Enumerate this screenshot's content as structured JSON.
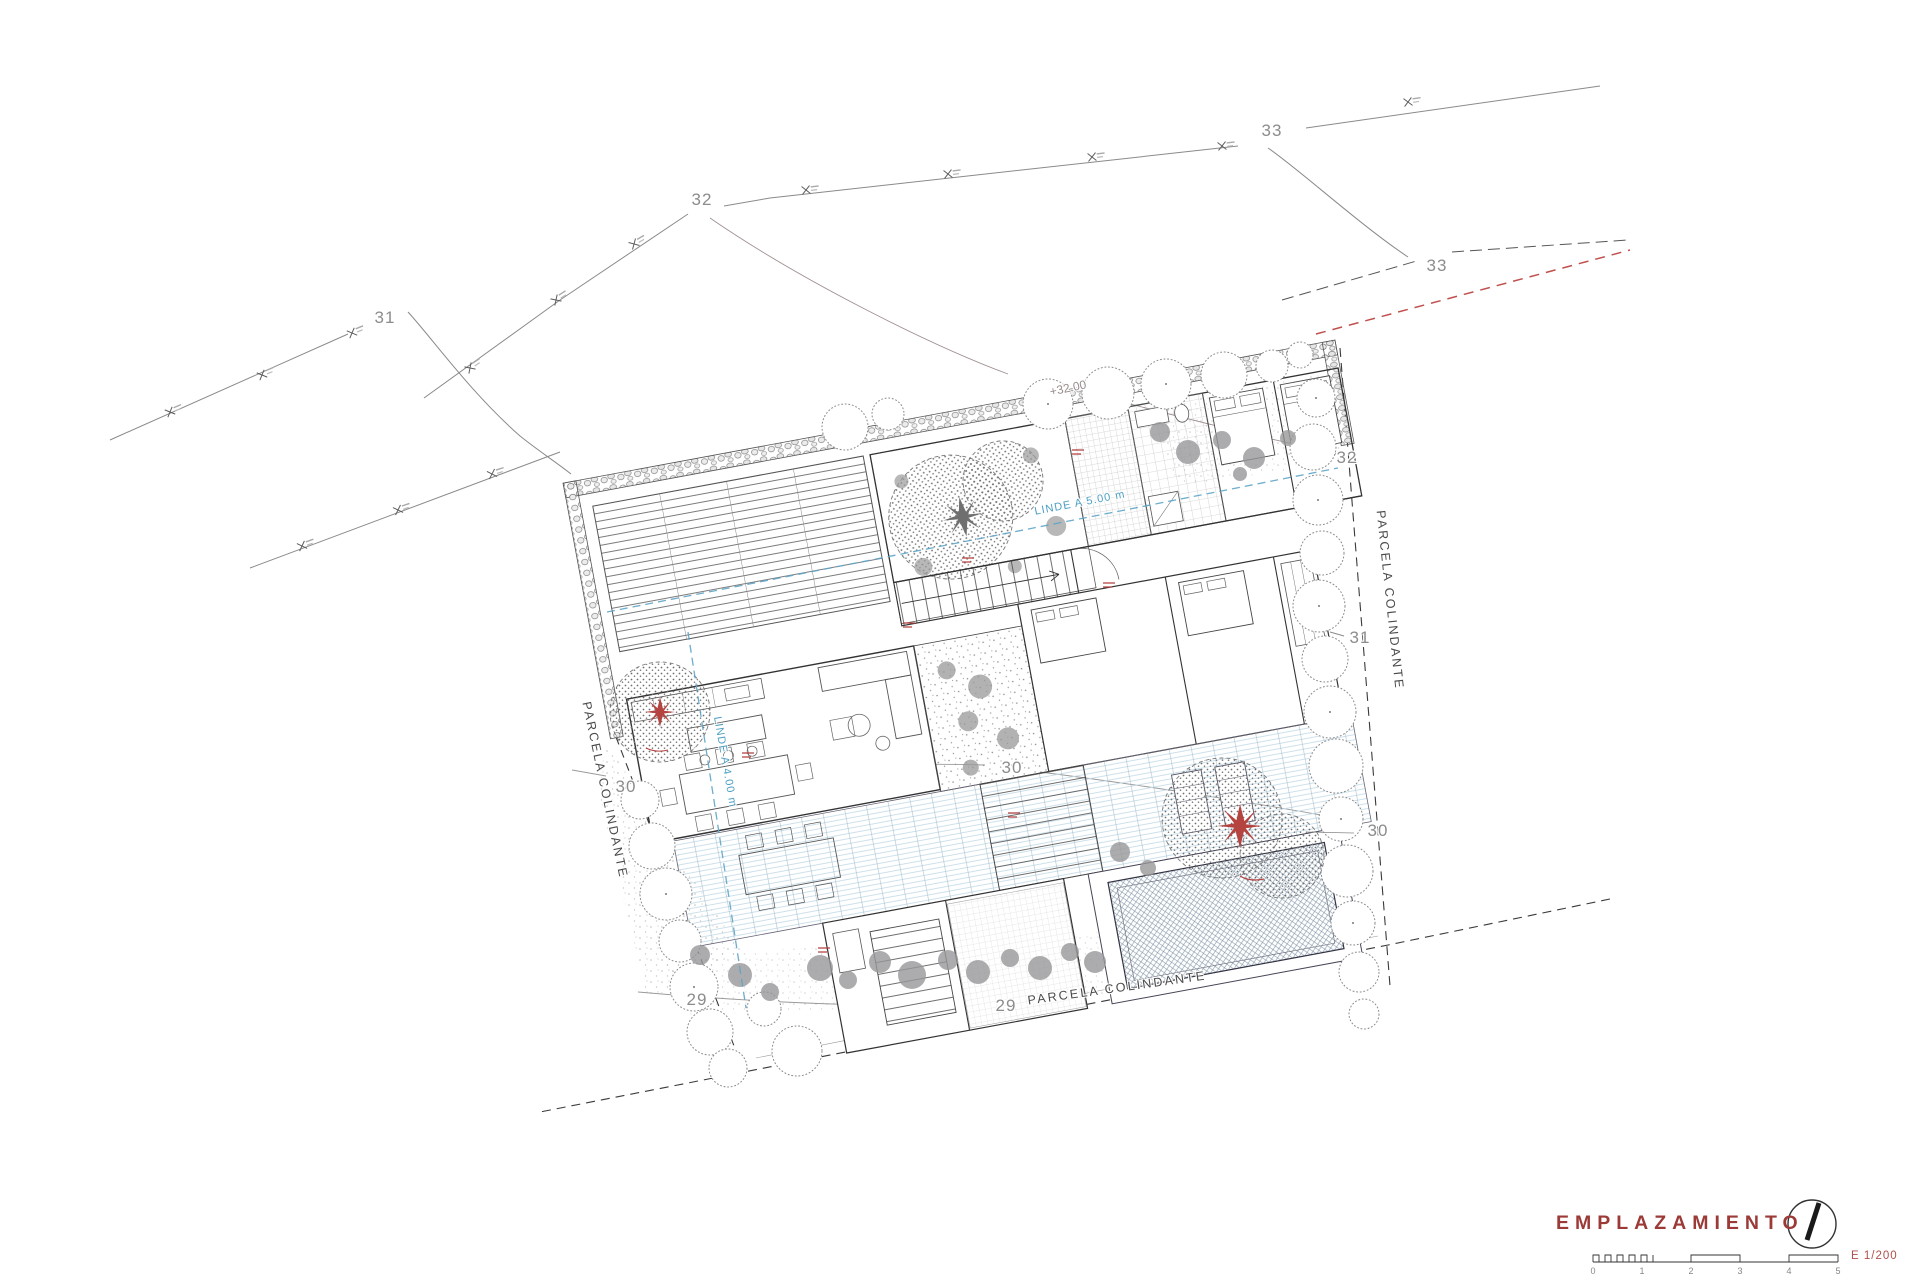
{
  "drawing": {
    "type": "architectural site plan",
    "colors": {
      "title_red": "#9c3a37",
      "linde_blue": "#4d9fc4",
      "contour_gray": "#8c8c8c",
      "red_dashed": "#c0504d",
      "wall_dark": "#333333"
    }
  },
  "labels": {
    "contours": [
      {
        "text": "31"
      },
      {
        "text": "32"
      },
      {
        "text": "33"
      },
      {
        "text": "33"
      },
      {
        "text": "32"
      },
      {
        "text": "31"
      },
      {
        "text": "30"
      },
      {
        "text": "30"
      },
      {
        "text": "30"
      },
      {
        "text": "29"
      },
      {
        "text": "29"
      },
      {
        "text": "+32.00"
      }
    ],
    "boundaries": [
      {
        "text": "PARCELA COLINDANTE"
      },
      {
        "text": "PARCELA COLINDANTE"
      },
      {
        "text": "PARCELA COLINDANTE"
      }
    ],
    "setbacks": [
      {
        "text": "LINDE A 5.00 m"
      },
      {
        "text": "LINDE A 4.00 m"
      }
    ]
  },
  "title_block": {
    "title": "EMPLAZAMIENTO",
    "scale_label": "E 1/200",
    "scale_ticks": [
      "0",
      "1",
      "2",
      "3",
      "4",
      "5"
    ]
  }
}
